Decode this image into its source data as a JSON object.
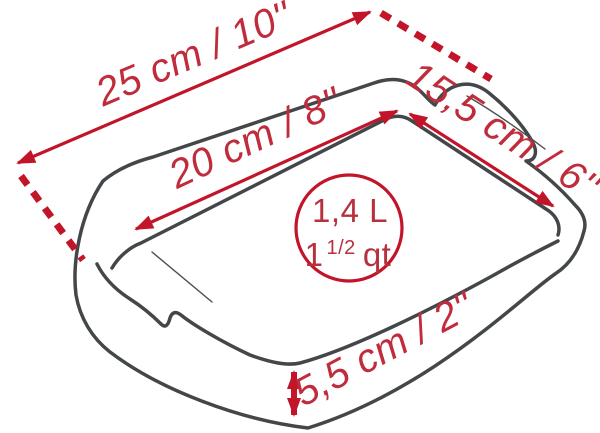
{
  "diagram": {
    "title": "baking-dish-dimensions",
    "product": "rectangular baking dish with handles",
    "colors": {
      "dimension_red": "#c2152a",
      "label_red": "#c02c3c",
      "outline_gray": "#43474a",
      "background": "#ffffff"
    },
    "dimensions": {
      "outer_length": {
        "label": "25 cm / 10''"
      },
      "inner_length": {
        "label": "20 cm / 8''"
      },
      "width": {
        "label": "15,5 cm / 6''"
      },
      "height": {
        "label": "5,5 cm / 2''"
      }
    },
    "capacity": {
      "liters": "1,4 L",
      "quarts_whole": "1",
      "quarts_fraction": "1/2",
      "quarts_unit": "qt"
    }
  }
}
